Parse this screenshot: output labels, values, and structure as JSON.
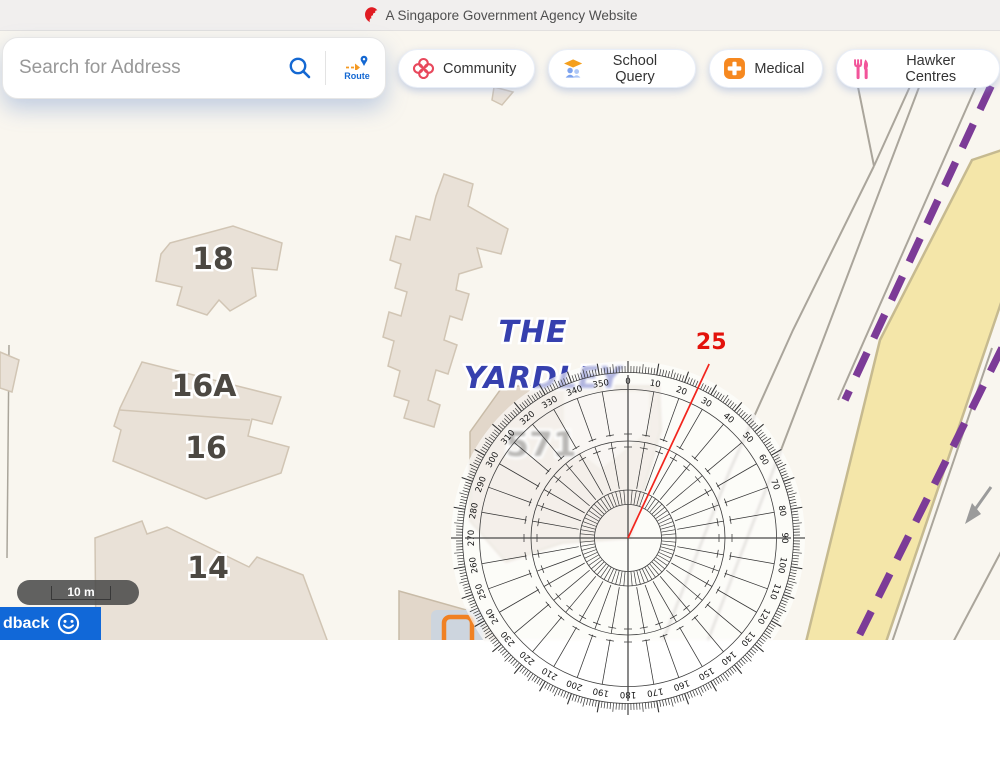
{
  "banner": {
    "text": "A Singapore Government Agency Website"
  },
  "search": {
    "placeholder": "Search for Address",
    "route_label": "Route"
  },
  "toolbar": {
    "buttons": [
      {
        "id": "community",
        "label": "Community"
      },
      {
        "id": "school-query",
        "label": "School Query"
      },
      {
        "id": "medical",
        "label": "Medical"
      },
      {
        "id": "hawker-centres",
        "label": "Hawker Centres"
      }
    ]
  },
  "map": {
    "building_labels": [
      {
        "text": "18",
        "x": 213,
        "y": 258,
        "size": 30
      },
      {
        "text": "16A",
        "x": 204,
        "y": 385,
        "size": 30
      },
      {
        "text": "16",
        "x": 206,
        "y": 447,
        "size": 30
      },
      {
        "text": "14",
        "x": 208,
        "y": 567,
        "size": 30
      },
      {
        "text": "571",
        "x": 541,
        "y": 444,
        "size": 34
      }
    ],
    "development_label": {
      "lines": [
        "THE",
        "YARDLEY"
      ],
      "x": [
        533,
        543
      ],
      "y": [
        331,
        377
      ],
      "size": 30
    },
    "scale_bar": {
      "label": "10 m"
    },
    "feedback": {
      "label": "dback"
    }
  },
  "protractor": {
    "center_x": 628,
    "center_y": 538,
    "outer_radius": 177,
    "degree_labels": [
      "0",
      "10",
      "20",
      "30",
      "40",
      "50",
      "60",
      "70",
      "80",
      "90",
      "100",
      "110",
      "120",
      "130",
      "140",
      "150",
      "160",
      "170",
      "180",
      "190",
      "200",
      "210",
      "220",
      "230",
      "240",
      "250",
      "260",
      "270",
      "280",
      "290",
      "300",
      "310",
      "320",
      "330",
      "340",
      "350"
    ],
    "measured_angle": 25,
    "measured_label": "25",
    "line_color": "#f2251d",
    "label_color": "#e3120b"
  },
  "colors": {
    "accent_blue": "#1468d2",
    "community_red": "#e8485c",
    "school_orange": "#f5a01e",
    "school_blue": "#7da3ef",
    "medical_orange": "#f6881f",
    "hawker_pink": "#f2549a",
    "purple_boundary": "#7c3b97",
    "yellow_road_fill": "#f4e6a9",
    "yellow_road_edge": "#c6ba90",
    "road_gray": "#aaa59b",
    "building_fill": "#e9e1d7",
    "building_edge": "#d1c5b4",
    "parcel_fill": "#e2d7ca",
    "parcel_edge": "#c8bba7",
    "map_bg": "#f9f6ef",
    "label_gray": "#4c4842",
    "development_blue": "#3640ae",
    "marker_orange": "#f08123",
    "feedback_blue": "#1168d8"
  }
}
